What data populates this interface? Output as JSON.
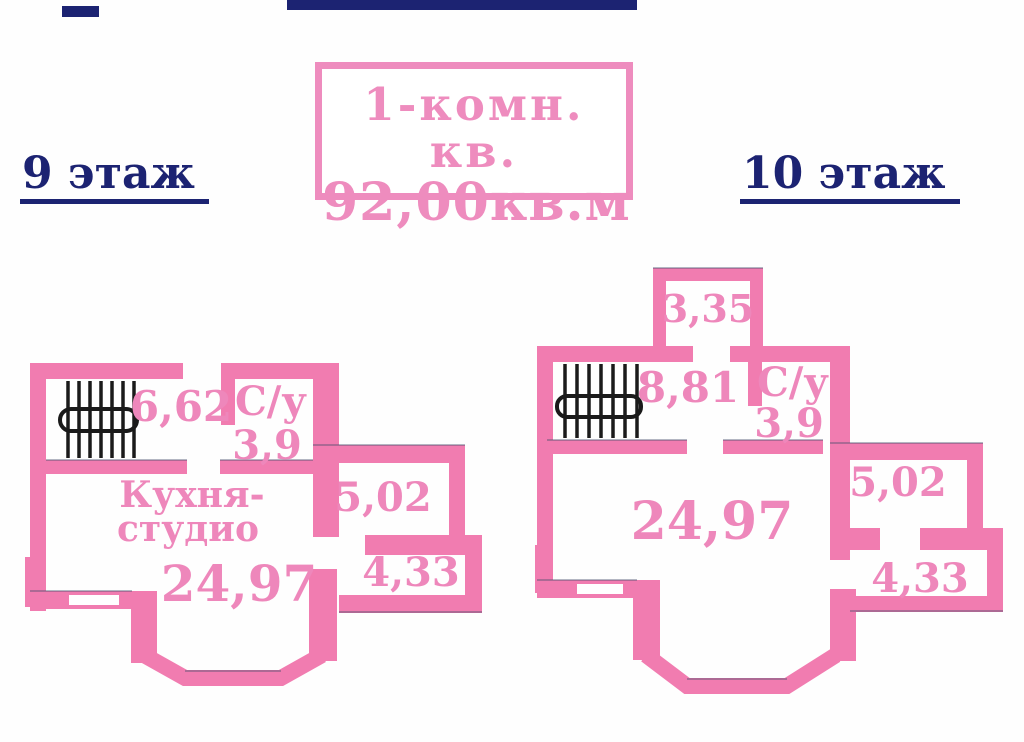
{
  "window": {
    "width": "1024",
    "height": "742"
  },
  "colors": {
    "wall_pink": "#F17CB0",
    "label_pink": "#EE87BB",
    "title_pink": "#EE8CBE",
    "navy": "#1C2372",
    "stair_black": "#1a1a1a"
  },
  "header": {
    "apartment_type": "1-комн. кв.",
    "apartment_area": "92,00кв.м",
    "floor9_label": "9 этаж",
    "floor10_label": "10 этаж"
  },
  "floor9_plan": {
    "stair_hall_area": "6,62",
    "bathroom_label": "С/у",
    "bathroom_area": "3,9",
    "kitchen_label_line1": "Кухня-",
    "kitchen_label_line2": "студио",
    "kitchen_area": "24,97",
    "storage_area": "5,02",
    "hall_area": "4,33"
  },
  "floor10_plan": {
    "balcony_area": "3,35",
    "stair_hall_area": "8,81",
    "bathroom_label": "С/у",
    "bathroom_area": "3,9",
    "room_area": "24,97",
    "storage_area": "5,02",
    "hall_area": "4,33"
  }
}
